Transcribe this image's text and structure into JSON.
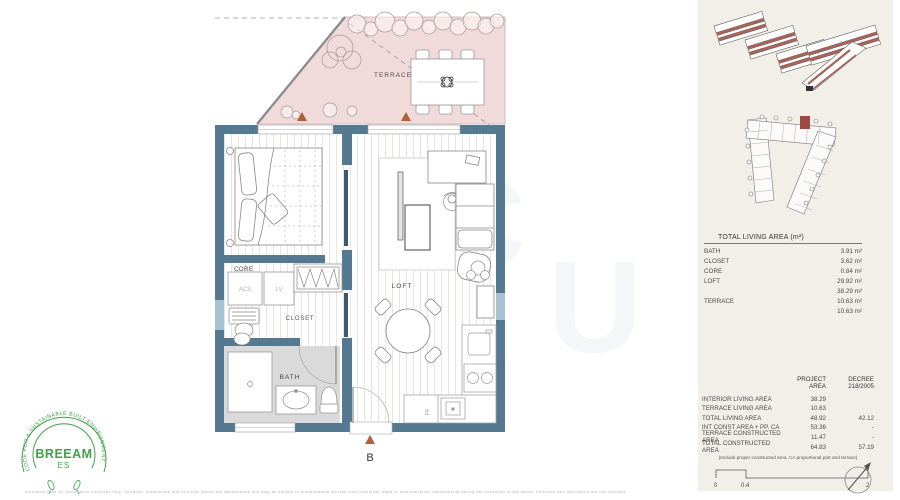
{
  "colors": {
    "wall": "#567992",
    "terrace_fill": "#f0dada",
    "window": "#a9c2d2",
    "triangle_accent": "#b45f3c",
    "unit_highlight": "#9c4a42",
    "logo_green": "#43a04b",
    "panel_background": "#f2efe9"
  },
  "plan_labels": {
    "terrace": "TERRACE",
    "core": "CORE",
    "acs": "ACS",
    "lv": "LV",
    "closet": "CLOSET",
    "bath": "BATH",
    "loft": "LOFT",
    "fridge": "FR",
    "entry_marker": "B"
  },
  "area_summary": {
    "title": "TOTAL LIVING AREA (m²)",
    "rows": [
      {
        "label": "BATH",
        "value": "3.91 m²"
      },
      {
        "label": "CLOSET",
        "value": "3.62 m²"
      },
      {
        "label": "CORE",
        "value": "0.84 m²"
      },
      {
        "label": "LOFT",
        "value": "29.92 m²"
      },
      {
        "label": "",
        "value": "38.29 m²"
      },
      {
        "label": "TERRACE",
        "value": "10.63 m²"
      },
      {
        "label": "",
        "value": "10.63 m²"
      }
    ]
  },
  "area_comparison": {
    "col1": "PROJECT\nAREA",
    "col2": "DECREE\n218/2005",
    "rows": [
      {
        "label": "INTERIOR LIVING AREA",
        "project": "38.29",
        "decree": ""
      },
      {
        "label": "TERRACE LIVING AREA",
        "project": "10.63",
        "decree": ""
      },
      {
        "label": "TOTAL LIVING AREA",
        "project": "48.92",
        "decree": "42.12"
      },
      {
        "label": "INT CONST AREA + PP. CA",
        "project": "53.36",
        "decree": "-"
      },
      {
        "label": "TERRACE CONSTRUCTED AREA",
        "project": "11.47",
        "decree": "-"
      },
      {
        "label": "TOTAL CONSTRUCTED AREA",
        "project": "64.83",
        "decree": "57.19"
      }
    ],
    "footnote": "(Include proper constructed area, CA proportional part and terrace)"
  },
  "scale_bar": {
    "tick0": "0",
    "tick1": "0.4",
    "tick2": "2"
  },
  "breeam": {
    "ring_text": "CODE FOR A SUSTAINABLE BUILT ENVIRONMENT",
    "name": "BREEAM",
    "sub": "ES"
  },
  "fine_print": "Indicative plan for information purposes only. Surfaces, dimensions and furniture layout are approximate and may be subject to modifications derived from technical, legal or administrative requirements during the execution of the works. Furniture and decoration are not included."
}
